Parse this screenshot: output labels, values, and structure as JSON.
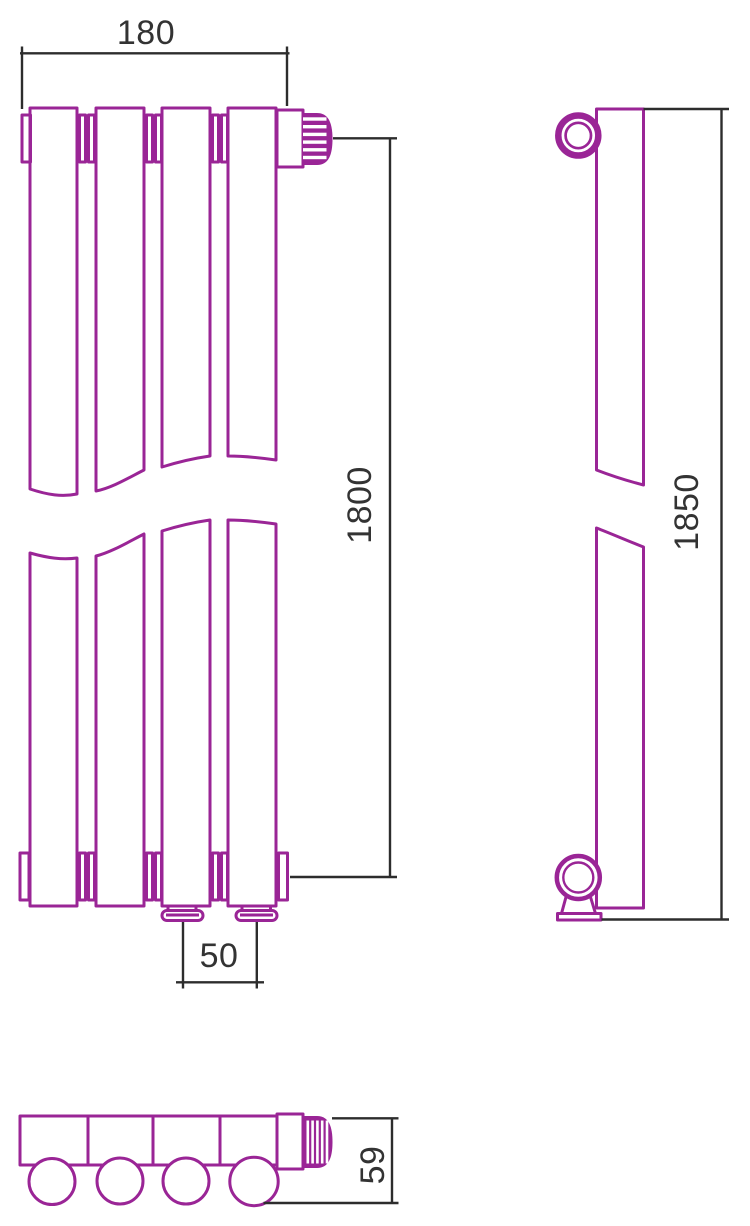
{
  "colors": {
    "outline": "#9a2596",
    "dimension_lines": "#2d2d2d",
    "label_text": "#333333",
    "background": "#ffffff"
  },
  "views": {
    "front": {
      "width": "180",
      "height": "1800",
      "pipe_spacing": "50"
    },
    "side": {
      "height": "1850"
    },
    "bottom": {
      "depth": "59"
    }
  }
}
